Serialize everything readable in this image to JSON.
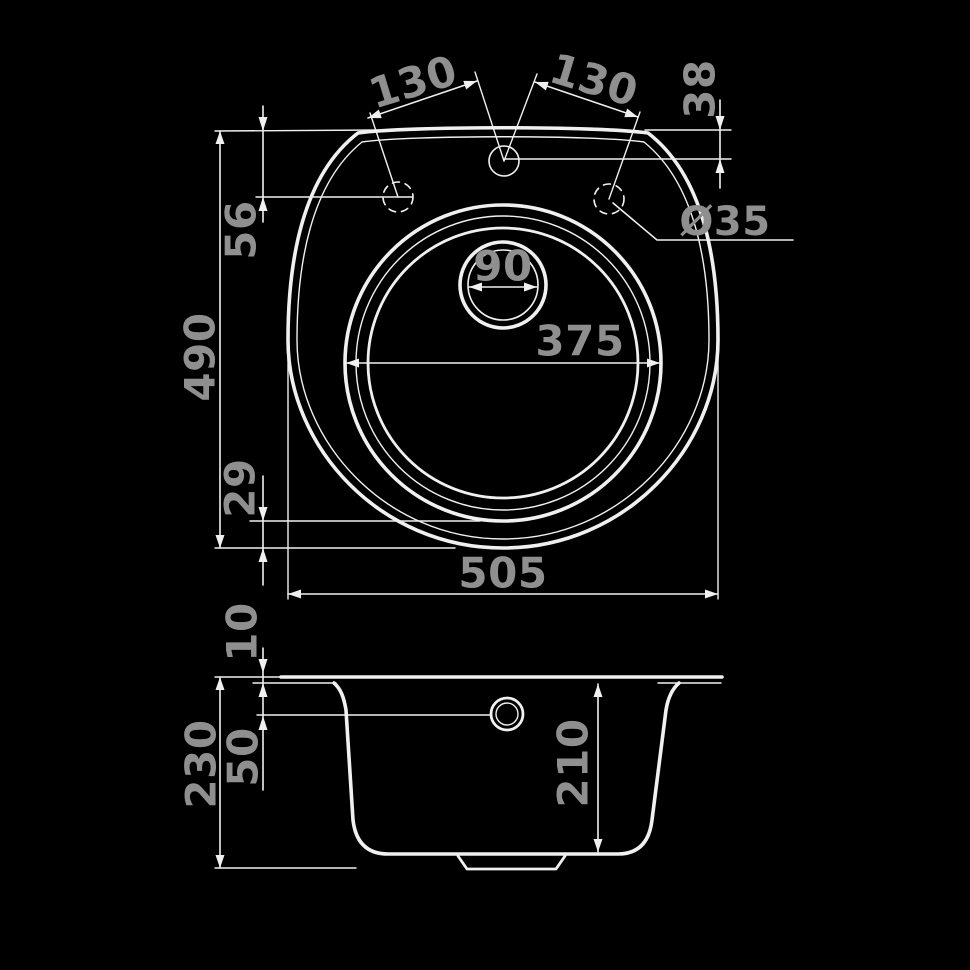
{
  "drawing": {
    "background_color": "#000000",
    "line_color": "#f0f0f0",
    "label_color": "#8f8f8f",
    "content": "sink-technical-drawing"
  },
  "top_view": {
    "hole_pitch_left": "130",
    "hole_pitch_right": "130",
    "hole_vertical_offset": "38",
    "deck_edge_offset": "56",
    "hole_diameter": "Ø35",
    "drain_diameter": "90",
    "bowl_diameter": "375",
    "overall_depth": "490",
    "bowl_bottom_gap": "29",
    "overall_width": "505"
  },
  "side_view": {
    "rim_thickness": "10",
    "overflow_offset": "50",
    "total_height": "230",
    "bowl_depth": "210"
  }
}
